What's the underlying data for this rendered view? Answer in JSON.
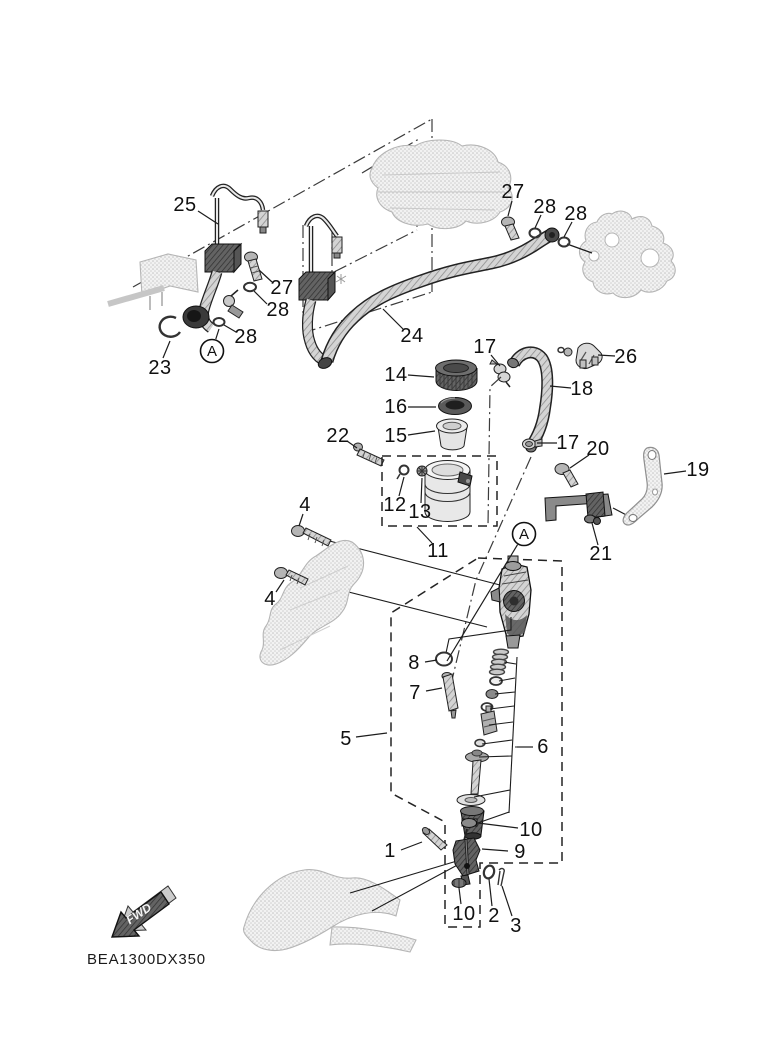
{
  "diagram": {
    "code": "BEA1300DX350",
    "direction_label": "FWD",
    "background": "#ffffff",
    "line_color": "#1a1a1a",
    "accent_dark": "#4a4a4a"
  },
  "callouts": [
    {
      "label": "25",
      "x": 185,
      "y": 205,
      "lx": 198,
      "ly": 211,
      "tx": 218,
      "ty": 224
    },
    {
      "label": "27",
      "x": 282,
      "y": 288,
      "lx": 272,
      "ly": 282,
      "tx": 259,
      "ty": 270
    },
    {
      "label": "28",
      "x": 278,
      "y": 310,
      "lx": 267,
      "ly": 304,
      "tx": 254,
      "ty": 291
    },
    {
      "label": "28",
      "x": 246,
      "y": 337,
      "lx": 236,
      "ly": 332,
      "tx": 224,
      "ty": 325
    },
    {
      "label": "23",
      "x": 160,
      "y": 368,
      "lx": 163,
      "ly": 358,
      "tx": 170,
      "ty": 341
    },
    {
      "label": "24",
      "x": 412,
      "y": 336,
      "lx": 403,
      "ly": 329,
      "tx": 383,
      "ty": 309
    },
    {
      "label": "27",
      "x": 513,
      "y": 192,
      "lx": 512,
      "ly": 201,
      "tx": 508,
      "ty": 216
    },
    {
      "label": "28",
      "x": 545,
      "y": 207,
      "lx": 541,
      "ly": 215,
      "tx": 535,
      "ty": 228
    },
    {
      "label": "28",
      "x": 576,
      "y": 214,
      "lx": 572,
      "ly": 222,
      "tx": 564,
      "ty": 237
    },
    {
      "label": "17",
      "x": 485,
      "y": 347,
      "lx": 491,
      "ly": 355,
      "tx": 500,
      "ty": 366
    },
    {
      "label": "26",
      "x": 626,
      "y": 357,
      "lx": 615,
      "ly": 356,
      "tx": 598,
      "ty": 355
    },
    {
      "label": "18",
      "x": 582,
      "y": 389,
      "lx": 571,
      "ly": 388,
      "tx": 550,
      "ty": 386
    },
    {
      "label": "14",
      "x": 396,
      "y": 375,
      "lx": 408,
      "ly": 375,
      "tx": 434,
      "ty": 377
    },
    {
      "label": "16",
      "x": 396,
      "y": 407,
      "lx": 408,
      "ly": 407,
      "tx": 436,
      "ty": 407
    },
    {
      "label": "15",
      "x": 396,
      "y": 436,
      "lx": 408,
      "ly": 435,
      "tx": 435,
      "ty": 431
    },
    {
      "label": "22",
      "x": 338,
      "y": 436,
      "lx": 347,
      "ly": 441,
      "tx": 357,
      "ty": 448
    },
    {
      "label": "12",
      "x": 395,
      "y": 505,
      "lx": 399,
      "ly": 496,
      "tx": 404,
      "ty": 477
    },
    {
      "label": "13",
      "x": 420,
      "y": 512,
      "lx": 421,
      "ly": 503,
      "tx": 422,
      "ty": 478
    },
    {
      "label": "11",
      "x": 438,
      "y": 551,
      "lx": 432,
      "ly": 543,
      "tx": 417,
      "ty": 527
    },
    {
      "label": "17",
      "x": 568,
      "y": 443,
      "lx": 557,
      "ly": 443,
      "tx": 537,
      "ty": 443
    },
    {
      "label": "20",
      "x": 598,
      "y": 449,
      "lx": 589,
      "ly": 455,
      "tx": 570,
      "ty": 468
    },
    {
      "label": "19",
      "x": 698,
      "y": 470,
      "lx": 686,
      "ly": 471,
      "tx": 664,
      "ty": 474
    },
    {
      "label": "21",
      "x": 601,
      "y": 554,
      "lx": 598,
      "ly": 545,
      "tx": 592,
      "ty": 523
    },
    {
      "label": "4",
      "x": 305,
      "y": 505,
      "lx": 303,
      "ly": 514,
      "tx": 299,
      "ty": 526
    },
    {
      "label": "4",
      "x": 270,
      "y": 599,
      "lx": 276,
      "ly": 592,
      "tx": 284,
      "ty": 580
    },
    {
      "label": "8",
      "x": 414,
      "y": 663,
      "lx": 425,
      "ly": 662,
      "tx": 437,
      "ty": 660
    },
    {
      "label": "7",
      "x": 415,
      "y": 693,
      "lx": 426,
      "ly": 691,
      "tx": 442,
      "ty": 688
    },
    {
      "label": "5",
      "x": 346,
      "y": 739,
      "lx": 356,
      "ly": 737,
      "tx": 387,
      "ty": 733
    },
    {
      "label": "6",
      "x": 543,
      "y": 747,
      "lx": 533,
      "ly": 747,
      "tx": 517,
      "ty": 747
    },
    {
      "label": "10",
      "x": 531,
      "y": 830,
      "lx": 518,
      "ly": 828,
      "tx": 478,
      "ty": 823
    },
    {
      "label": "9",
      "x": 520,
      "y": 852,
      "lx": 508,
      "ly": 851,
      "tx": 482,
      "ty": 849
    },
    {
      "label": "1",
      "x": 390,
      "y": 851,
      "lx": 401,
      "ly": 850,
      "tx": 422,
      "ty": 842
    },
    {
      "label": "10",
      "x": 464,
      "y": 914,
      "lx": 461,
      "ly": 904,
      "tx": 459,
      "ty": 888
    },
    {
      "label": "2",
      "x": 494,
      "y": 916,
      "lx": 492,
      "ly": 906,
      "tx": 489,
      "ty": 879
    },
    {
      "label": "3",
      "x": 516,
      "y": 926,
      "lx": 512,
      "ly": 916,
      "tx": 502,
      "ty": 886
    }
  ],
  "view_markers": [
    {
      "label": "A",
      "x": 212,
      "y": 351,
      "tx": 219,
      "ty": 329
    },
    {
      "label": "A",
      "x": 524,
      "y": 534,
      "tx": 447,
      "ty": 661
    }
  ]
}
